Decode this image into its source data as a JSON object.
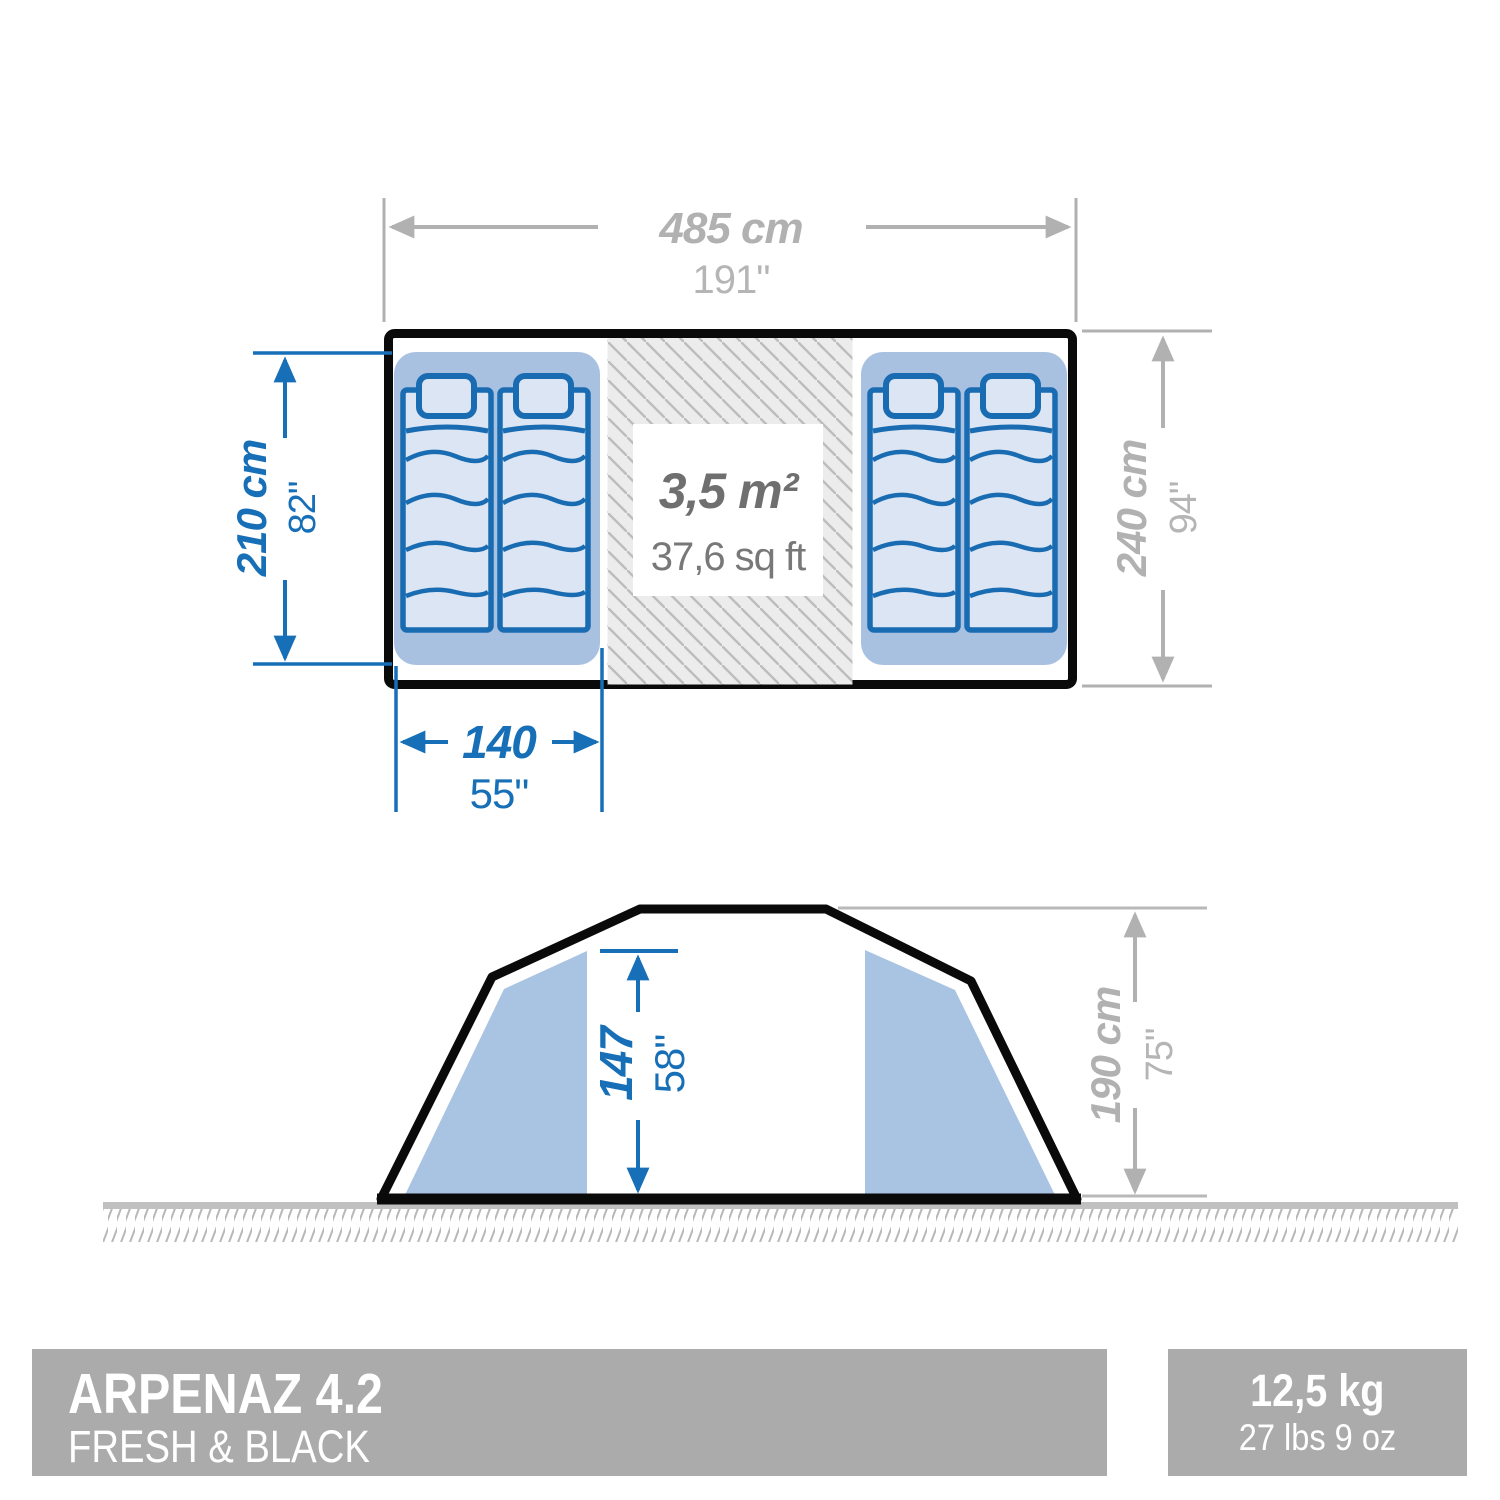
{
  "product": {
    "name": "ARPENAZ 4.2",
    "line": "FRESH & BLACK"
  },
  "weight": {
    "metric": "12,5 kg",
    "imperial": "27 lbs 9 oz"
  },
  "floor_plan": {
    "width_metric": "485 cm",
    "width_imperial": "191\"",
    "depth_metric": "240 cm",
    "depth_imperial": "94\"",
    "cabin_length_metric": "210 cm",
    "cabin_length_imperial": "82\"",
    "cabin_width_metric": "140",
    "cabin_width_imperial": "55\"",
    "area_metric": "3,5 m²",
    "area_imperial": "37,6 sq ft"
  },
  "side_view": {
    "interior_height_metric": "147",
    "interior_height_imperial": "58\"",
    "total_height_metric": "190 cm",
    "total_height_imperial": "75\""
  },
  "colors": {
    "dimension_blue": "#176fb7",
    "dimension_gray": "#b1b1b1",
    "area_text_gray": "#6f6f6f",
    "cabin_blue": "#a9c1e1",
    "mattress_fill": "#dbe5f3",
    "mattress_stroke": "#1a6cb2",
    "outline_black": "#0a0a0a",
    "footer_bar_gray": "#ababab"
  }
}
